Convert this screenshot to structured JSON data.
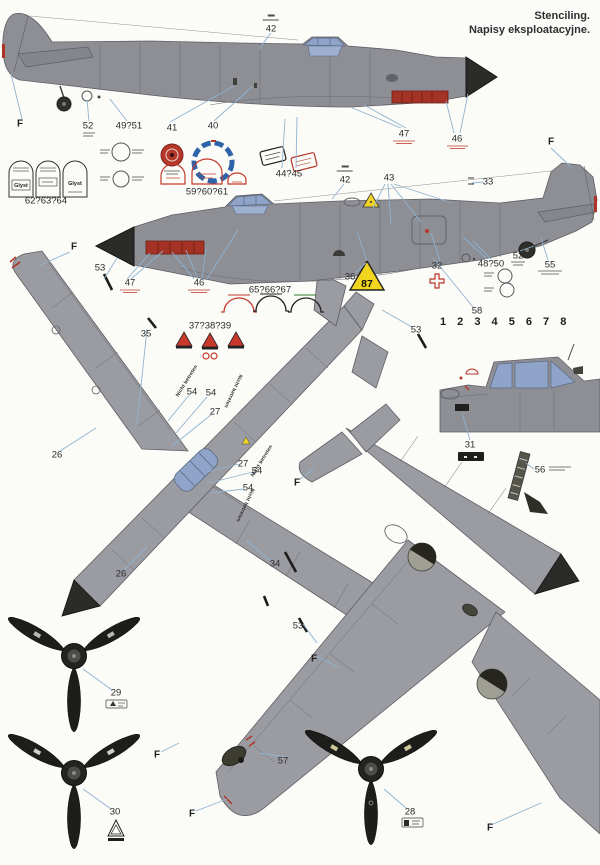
{
  "header": {
    "title_en": "Stenciling.",
    "title_pl": "Napisy eksploatacyjne."
  },
  "palette": {
    "paper": "#fbfbf7",
    "airframe_gray": "#8e8e95",
    "planform_gray": "#9b9ba2",
    "canopy_blue": "#8fa4c8",
    "spinner_black": "#2b2b29",
    "exhaust_red": "#a53325",
    "stencil_red": "#c23a2c",
    "warning_yellow": "#f0d32a",
    "leader_blue": "#8fb3d1",
    "ink": "#2b2b2e"
  },
  "figures": [
    "fuselage left profile",
    "fuselage right profile",
    "upper planform view",
    "lower planform view",
    "cockpit side detail",
    "propeller front view x3"
  ],
  "callouts": [
    {
      "label": "F",
      "x": 20,
      "y": 124,
      "cls": "f"
    },
    {
      "label": "52",
      "x": 88,
      "y": 126
    },
    {
      "label": "49?51",
      "x": 129,
      "y": 126
    },
    {
      "label": "41",
      "x": 172,
      "y": 128
    },
    {
      "label": "40",
      "x": 213,
      "y": 126
    },
    {
      "label": "42",
      "x": 271,
      "y": 27,
      "cls": "fraction"
    },
    {
      "label": "44?45",
      "x": 289,
      "y": 174
    },
    {
      "label": "47",
      "x": 404,
      "y": 134
    },
    {
      "label": "46",
      "x": 457,
      "y": 139
    },
    {
      "label": "62?63?64",
      "x": 46,
      "y": 201
    },
    {
      "label": "59?60?61",
      "x": 207,
      "y": 192
    },
    {
      "label": "F",
      "x": 74,
      "y": 247,
      "cls": "f"
    },
    {
      "label": "53",
      "x": 100,
      "y": 268
    },
    {
      "label": "47",
      "x": 130,
      "y": 283
    },
    {
      "label": "46",
      "x": 199,
      "y": 283
    },
    {
      "label": "35",
      "x": 146,
      "y": 334
    },
    {
      "label": "42",
      "x": 345,
      "y": 178,
      "cls": "fraction"
    },
    {
      "label": "43",
      "x": 389,
      "y": 178
    },
    {
      "label": "33",
      "x": 488,
      "y": 182
    },
    {
      "label": "F",
      "x": 551,
      "y": 142,
      "cls": "f"
    },
    {
      "label": "36",
      "x": 350,
      "y": 277
    },
    {
      "label": "87",
      "x": 367,
      "y": 284,
      "cls": "s87"
    },
    {
      "label": "32",
      "x": 437,
      "y": 266
    },
    {
      "label": "48?50",
      "x": 491,
      "y": 264
    },
    {
      "label": "52",
      "x": 518,
      "y": 256
    },
    {
      "label": "55",
      "x": 550,
      "y": 265
    },
    {
      "label": "58",
      "x": 477,
      "y": 311
    },
    {
      "label": "53",
      "x": 416,
      "y": 330
    },
    {
      "label": "65?66?67",
      "x": 270,
      "y": 290
    },
    {
      "label": "37?38?39",
      "x": 210,
      "y": 326
    },
    {
      "label": "1 2 3 4 5 6 7 8",
      "x": 440,
      "y": 322,
      "cls": "strip"
    },
    {
      "label": "26",
      "x": 57,
      "y": 455
    },
    {
      "label": "54",
      "x": 192,
      "y": 392
    },
    {
      "label": "54",
      "x": 211,
      "y": 393
    },
    {
      "label": "27",
      "x": 215,
      "y": 412
    },
    {
      "label": "Nicht betreten",
      "x": 187,
      "y": 381,
      "cls": "walk",
      "rot": -58
    },
    {
      "label": "Nicht betreten",
      "x": 233,
      "y": 391,
      "cls": "walk",
      "rot": 115
    },
    {
      "label": "27",
      "x": 243,
      "y": 464
    },
    {
      "label": "54",
      "x": 257,
      "y": 471
    },
    {
      "label": "54",
      "x": 248,
      "y": 488
    },
    {
      "label": "Nicht betreten",
      "x": 262,
      "y": 461,
      "cls": "walk",
      "rot": -58
    },
    {
      "label": "Nicht betreten",
      "x": 245,
      "y": 505,
      "cls": "walk",
      "rot": 115
    },
    {
      "label": "26",
      "x": 121,
      "y": 574
    },
    {
      "label": "34",
      "x": 275,
      "y": 564
    },
    {
      "label": "F",
      "x": 297,
      "y": 483,
      "cls": "f"
    },
    {
      "label": "53",
      "x": 298,
      "y": 626
    },
    {
      "label": "F",
      "x": 314,
      "y": 659,
      "cls": "f"
    },
    {
      "label": "31",
      "x": 470,
      "y": 445
    },
    {
      "label": "56",
      "x": 540,
      "y": 470
    },
    {
      "label": "57",
      "x": 283,
      "y": 761
    },
    {
      "label": "F",
      "x": 157,
      "y": 755,
      "cls": "f"
    },
    {
      "label": "F",
      "x": 192,
      "y": 814,
      "cls": "f"
    },
    {
      "label": "29",
      "x": 116,
      "y": 693
    },
    {
      "label": "30",
      "x": 115,
      "y": 812
    },
    {
      "label": "28",
      "x": 410,
      "y": 812
    },
    {
      "label": "F",
      "x": 490,
      "y": 828,
      "cls": "f"
    },
    {
      "label": "Glyst",
      "x": 21,
      "y": 186,
      "cls": "glyst"
    },
    {
      "label": "Glyst",
      "x": 75,
      "y": 184,
      "cls": "glyst"
    }
  ]
}
